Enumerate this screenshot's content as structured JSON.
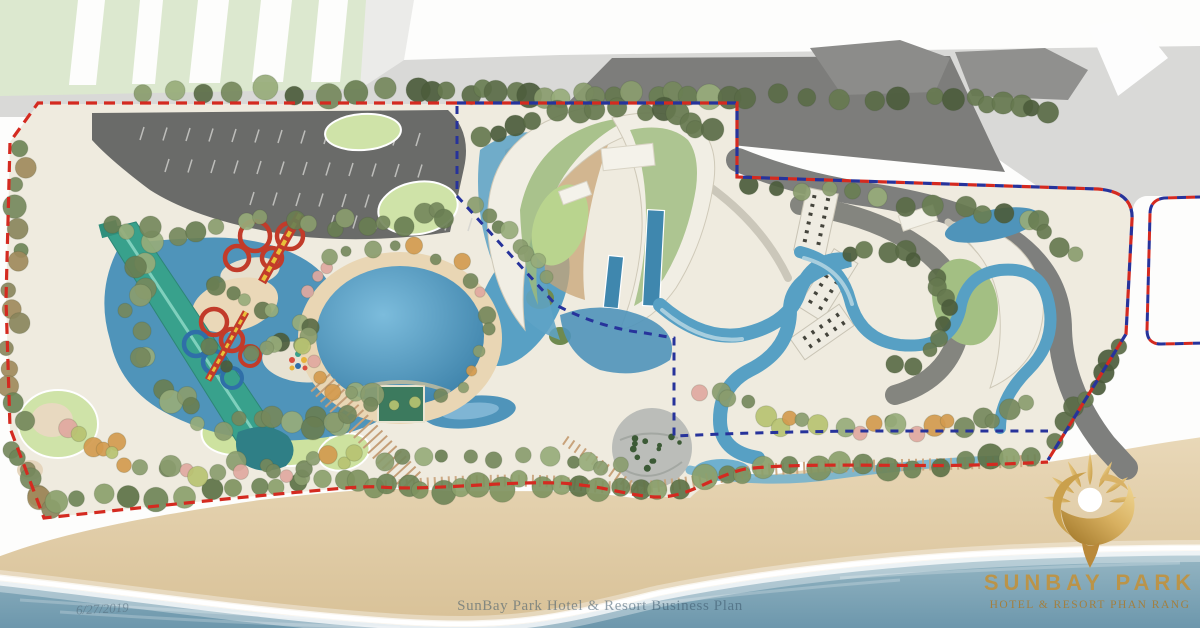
{
  "document": {
    "type": "resort-master-plan-illustration",
    "brand": "SunBay Park Hotel & Resort Phan Rang"
  },
  "logo": {
    "emblem": "golden-sun-over-dune-emblem",
    "title": "SUNBAY PARK",
    "subtitle": "HOTEL & RESORT PHAN RANG",
    "gold": "#c2913a",
    "gold_light": "#edd08c",
    "gold_deep": "#9c7224"
  },
  "watermark": {
    "text": "SunBay Park Hotel & Resort Business Plan"
  },
  "corner_note": {
    "text": "6/27/2019"
  },
  "boundaries": {
    "site_outline": {
      "style": "dashed",
      "color": "#d42a20"
    },
    "phase_outline": {
      "style": "dashed",
      "color": "#27339b"
    },
    "combined_outline": {
      "style": "dashed",
      "colors": [
        "#d42a20",
        "#27339b"
      ]
    }
  },
  "palette": {
    "road_light": "#d9d9d7",
    "road_dark": "#7d7d7b",
    "parking": "#6a6b69",
    "block_green": "#dce8cf",
    "ground": "#efebdf",
    "water": "#4f94ba",
    "water_light": "#7cbcdc",
    "water_deep": "#3b80a8",
    "lagoon": "#58a0c4",
    "sand": "#e9d6b4",
    "beach": "#ddc9a4",
    "ocean": "#6f9cb1",
    "foam": "#ffffff",
    "lawn": "#cfe3a8",
    "tree_green": "#75885c",
    "tree_dark": "#55663f",
    "building_cream": "#f1eee4",
    "roof_garden": "#9cba7c",
    "deck_wood": "#c8a476",
    "slide_red": "#c23b2a",
    "slide_yellow": "#e8c23a",
    "slide_blue": "#2f6fa8",
    "slide_teal": "#38a18c",
    "plaza_gray": "#b7bbb6"
  },
  "map_features": [
    "street-grid",
    "roadside-buildings",
    "parking-lot",
    "tree-belts",
    "water-park-lazy-river",
    "red-water-slides",
    "blue-water-slides",
    "green-speed-slide",
    "island-pavilion",
    "oval-wave-pool",
    "stage",
    "lagoon-with-islands",
    "crescent-hotel-buildings",
    "roof-gardens",
    "lap-pools",
    "sun-decks",
    "serpentine-river-pools",
    "palm-plaza",
    "lawn-ovals",
    "boardwalk",
    "beach",
    "surf",
    "sea",
    "excluded-plot"
  ]
}
